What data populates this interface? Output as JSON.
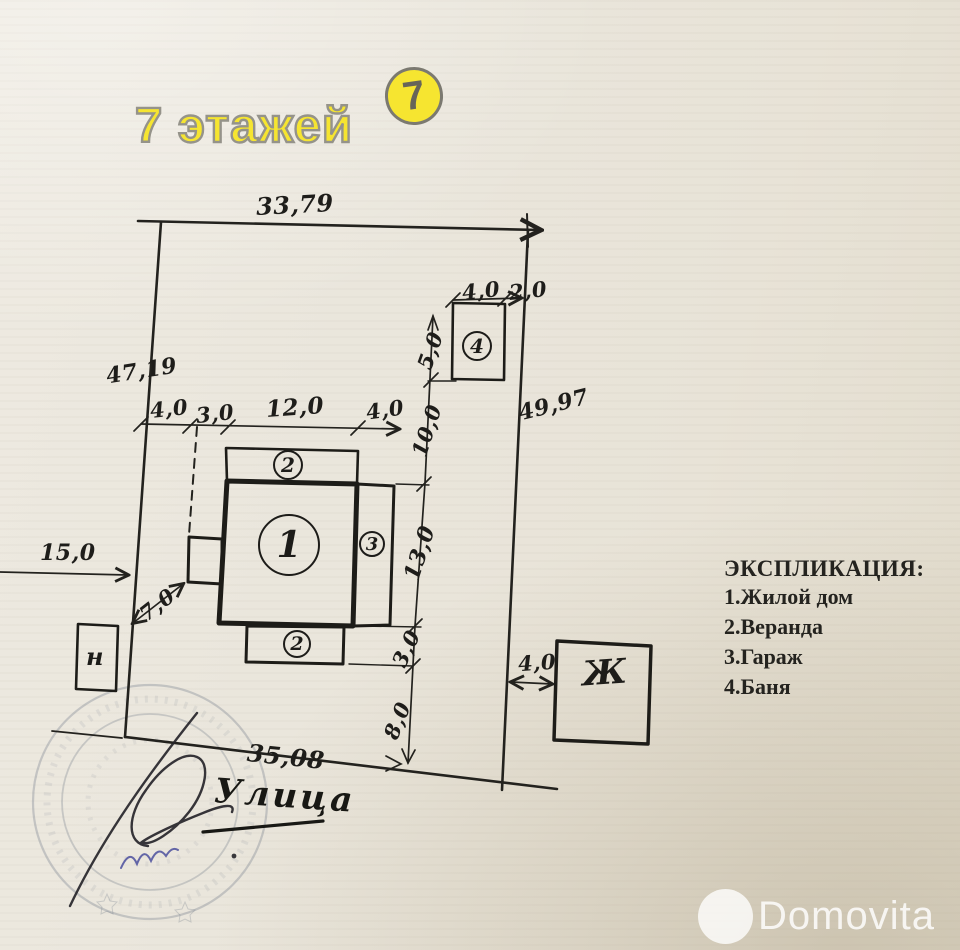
{
  "brand": {
    "watermark_text": "7 этажей",
    "watermark_digit": "7",
    "photo_watermark": "Domovita"
  },
  "legend": {
    "title": "ЭКСПЛИКАЦИЯ:",
    "items": [
      "1.Жилой дом",
      "2.Веранда",
      "3.Гараж",
      "4.Баня"
    ]
  },
  "street": {
    "label": "Улица"
  },
  "plot": {
    "top": "33,79",
    "left": "47,19",
    "right": "49,97",
    "bottom": "35,08",
    "offset_left": "15,0"
  },
  "chain_top": {
    "d1": "4,0",
    "d2": "3,0",
    "d3": "12,0",
    "d4": "4,0",
    "d5": "10,0"
  },
  "chain_right": {
    "bath_height": "5,0",
    "house_height": "13,0",
    "veranda_depth": "3,0",
    "to_street": "8,0"
  },
  "house": {
    "circle": "1"
  },
  "veranda_top": {
    "circle": "2"
  },
  "veranda_bottom": {
    "circle": "2"
  },
  "garage": {
    "circle": "3"
  },
  "bath": {
    "circle": "4",
    "width": "4,0",
    "gap_right": "2,0"
  },
  "annex": {
    "gap": "7,0"
  },
  "shed": {
    "letter": "н"
  },
  "neighbor": {
    "letter": "Ж",
    "gap": "4,0"
  }
}
